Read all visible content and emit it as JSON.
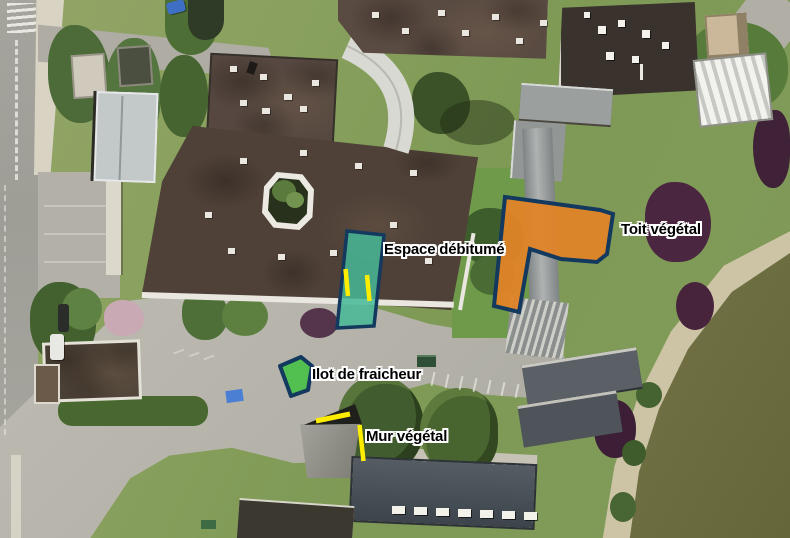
{
  "annotations": {
    "espace_debitume": {
      "label": "Espace débitumé",
      "fill": "#45b896",
      "fill_opacity": "0.85",
      "outline": "#14395f",
      "marks_color": "#ffed00"
    },
    "toit_vegetal": {
      "label": "Toit végétal",
      "fill": "#e08428",
      "fill_opacity": "0.95",
      "outline": "#14395f"
    },
    "ilot_de_fraicheur": {
      "label": "Ilot de fraicheur",
      "fill": "#4cc14b",
      "fill_opacity": "0.95",
      "outline": "#14395f"
    },
    "mur_vegetal": {
      "label": "Mur végétal",
      "line_color": "#ffed00"
    }
  },
  "base_map": {
    "type": "aerial-photo",
    "water_color": "#6d6e41",
    "grass_color": "#849c5a",
    "pavement_color": "#b7b5ac"
  }
}
